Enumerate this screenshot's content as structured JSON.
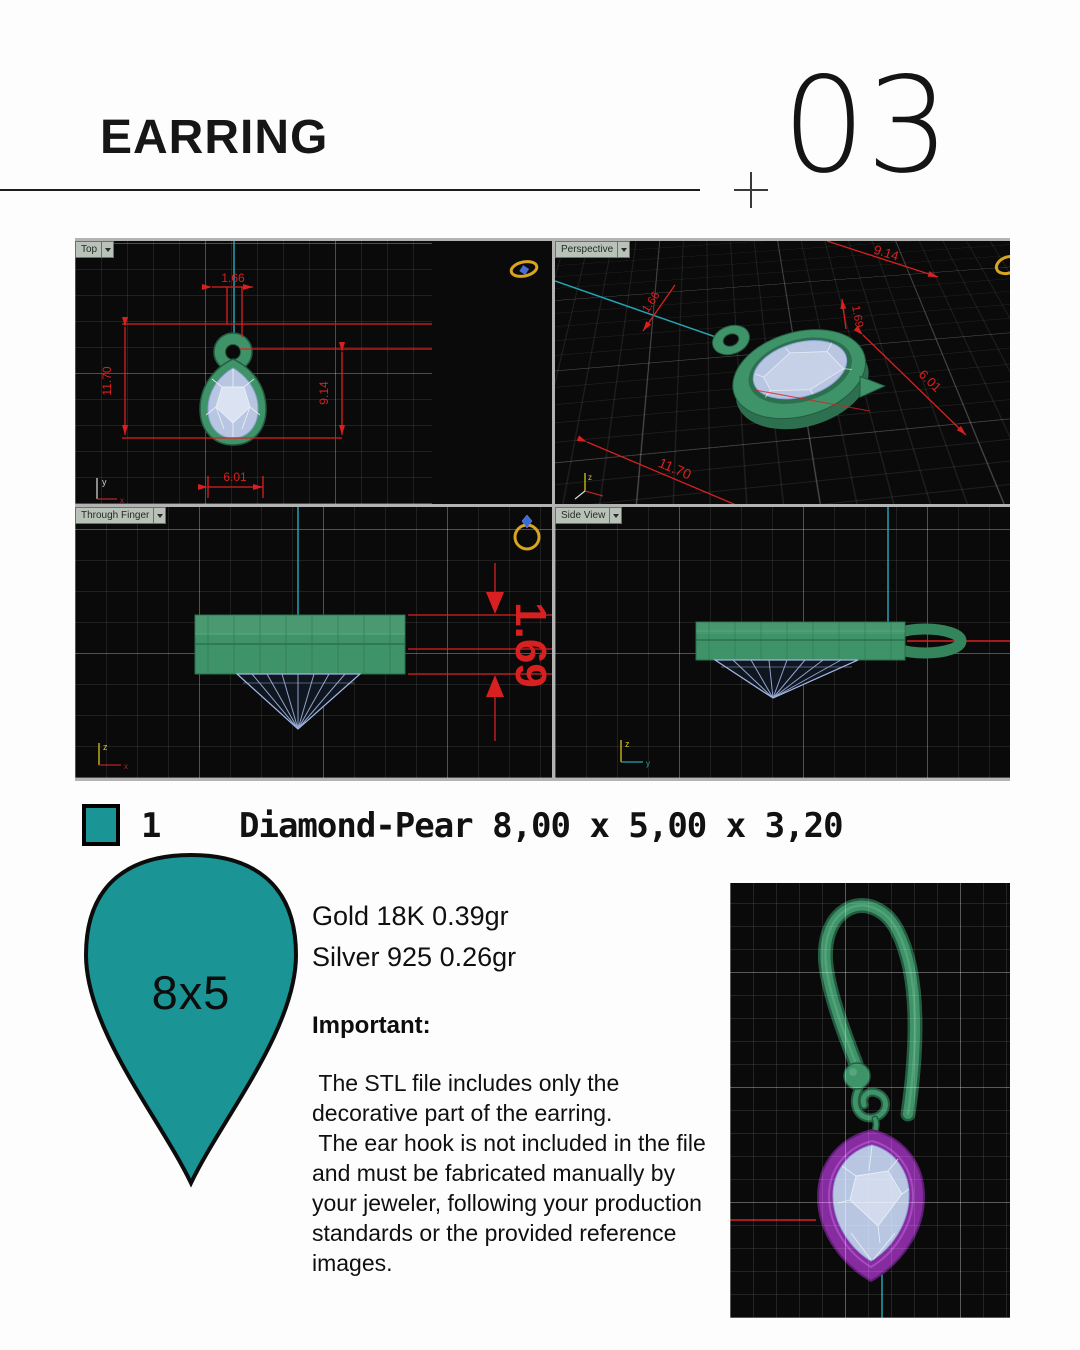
{
  "header": {
    "title": "EARRING",
    "page_number": "03"
  },
  "viewports": {
    "top": {
      "label": "Top",
      "dim_width_top": "1.66",
      "dim_height_total": "11.70",
      "dim_height_stone": "9.14",
      "dim_width_stone": "6.01"
    },
    "perspective": {
      "label": "Perspective",
      "dim_a": "9.14",
      "dim_b": "1.66",
      "dim_c": "1.69",
      "dim_d": "6.01",
      "dim_e": "11.70"
    },
    "through_finger": {
      "label": "Through Finger",
      "dim_thickness": "1.69"
    },
    "side_view": {
      "label": "Side View"
    }
  },
  "axes": {
    "x": "x",
    "y": "y",
    "z": "z"
  },
  "legend": {
    "count": "1",
    "description": "Diamond-Pear 8,00 x 5,00 x 3,20"
  },
  "stone": {
    "size_label": "8x5"
  },
  "materials": {
    "gold": "Gold 18K 0.39gr",
    "silver": "Silver 925 0.26gr"
  },
  "important": {
    "heading": "Important:",
    "paragraph1": " The STL file includes only the decorative part of the earring.",
    "paragraph2": " The ear hook is not included in the file and must be fabricated manually by your jeweler, following your production standards or the provided reference images."
  },
  "colors": {
    "teal": "#1a9494",
    "cad_green": "#3f9368",
    "cad_green_dark": "#2c7050",
    "gem_blue": "#b9c6e2",
    "bezel_purple": "#872ba0",
    "dimension_red": "#d92020",
    "cyan_axis": "#25a3b4",
    "gold_icon": "#d9a521"
  }
}
